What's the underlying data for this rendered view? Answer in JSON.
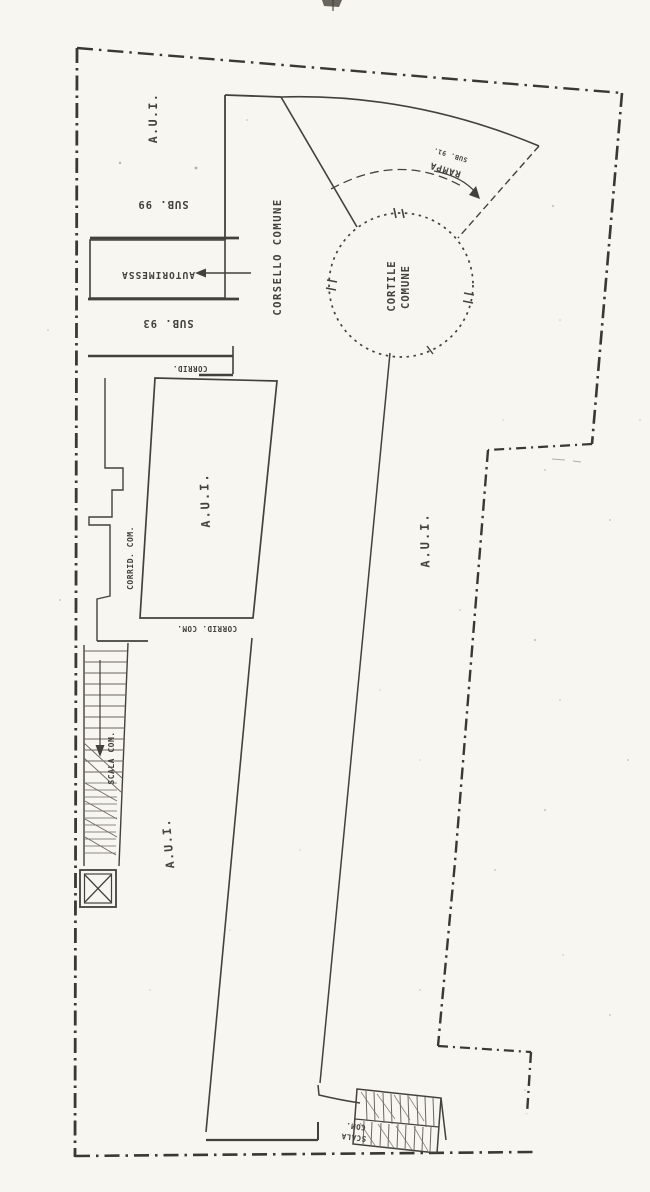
{
  "plan": {
    "labels": {
      "aui_top_left": "A.U.I.",
      "sub_99": "SUB. 99",
      "autorimessa": "AUTORIMESSA",
      "sub_93": "SUB. 93",
      "corrid_top": "CORRID.",
      "corsello_comune": "CORSELLO COMUNE",
      "cortile_line1": "CORTILE",
      "cortile_line2": "COMUNE",
      "rampa": "RAMPA",
      "rampa_sub": "SUB. 91.",
      "aui_middle": "A.U.I.",
      "corrid_com_left": "CORRID. COM.",
      "corrid_com_bottom": "CORRID. COM.",
      "scala_com_left": "SCALA COM.",
      "aui_lower_left": "A.U.I.",
      "aui_right": "A.U.I.",
      "scala_bottom_line1": "SCALA",
      "scala_bottom_line2": "COM."
    },
    "colors": {
      "ink": "#43413b",
      "boundary": "#3a3833",
      "paper": "#f7f6f1",
      "faded": "#6b675f"
    }
  }
}
